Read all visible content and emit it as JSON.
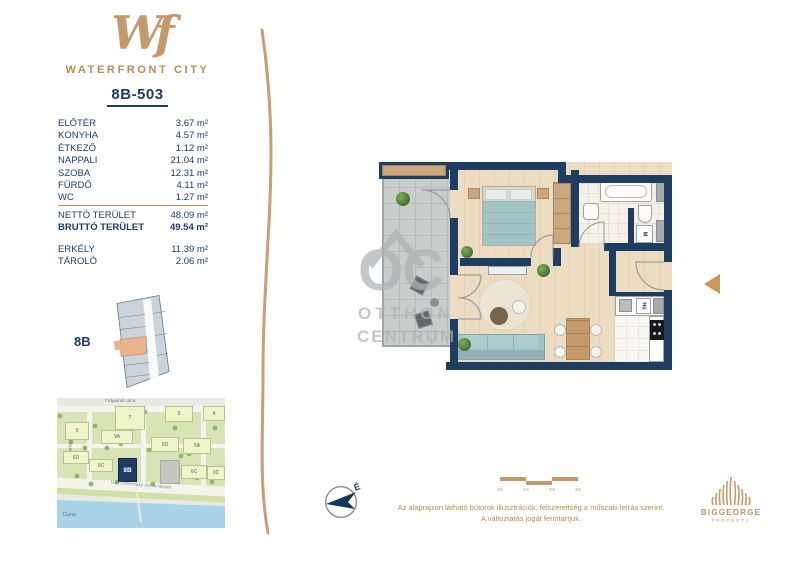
{
  "colors": {
    "accent_gold": "#bf8c52",
    "navy": "#1e3b66",
    "wall_navy": "#1f3d60",
    "teal": "#a5c6c6"
  },
  "header": {
    "logo_mark": "Wf",
    "brand": "WATERFRONT CITY",
    "unit_id": "8B-503"
  },
  "area_table": {
    "rooms": [
      {
        "label": "ELŐTÉR",
        "area": "3.67 m²"
      },
      {
        "label": "KONYHA",
        "area": "4.57 m²"
      },
      {
        "label": "ÉTKEZŐ",
        "area": "1.12 m²"
      },
      {
        "label": "NAPPALI",
        "area": "21.04 m²"
      },
      {
        "label": "SZOBA",
        "area": "12.31 m²"
      },
      {
        "label": "FÜRDŐ",
        "area": "4.11 m²"
      },
      {
        "label": "WC",
        "area": "1.27 m²"
      }
    ],
    "totals": [
      {
        "label": "NETTÓ TERÜLET",
        "area": "48.09 m²"
      },
      {
        "label": "BRUTTÓ TERÜLET",
        "area": "49.54 m²"
      }
    ],
    "extras": [
      {
        "label": "ERKÉLY",
        "area": "11.39 m²"
      },
      {
        "label": "TÁROLÓ",
        "area": "2.06 m²"
      }
    ]
  },
  "key_plan": {
    "building_label": "8B"
  },
  "map": {
    "street_top": "Folyamőr utca",
    "street_left": "Matróz utca",
    "embankment": "Gróf Eszterházy János rakpart",
    "river": "Duna",
    "buildings": [
      "9",
      "7",
      "5",
      "4",
      "9A",
      "6D",
      "5A",
      "6D",
      "9C",
      "8B",
      "6C",
      "3C"
    ]
  },
  "floor_plan": {
    "washer_label": "M",
    "fridge_label": "Hű"
  },
  "watermark": {
    "mark": "OC",
    "line1": "OTTHON",
    "line2": "CENTRUM"
  },
  "compass": {
    "north_label": "É"
  },
  "scale_bar": {
    "ticks": [
      "0m",
      "1m",
      "2m",
      "3m"
    ]
  },
  "disclaimer": {
    "line1": "Az alaprajzon látható bútorok illusztrációk, felszereltség a műszaki leírás szerint.",
    "line2": "A változtatás jogát fenntartjuk."
  },
  "footer": {
    "brand": "BIGGEORGE",
    "brand_sub": "PROPERTY"
  }
}
